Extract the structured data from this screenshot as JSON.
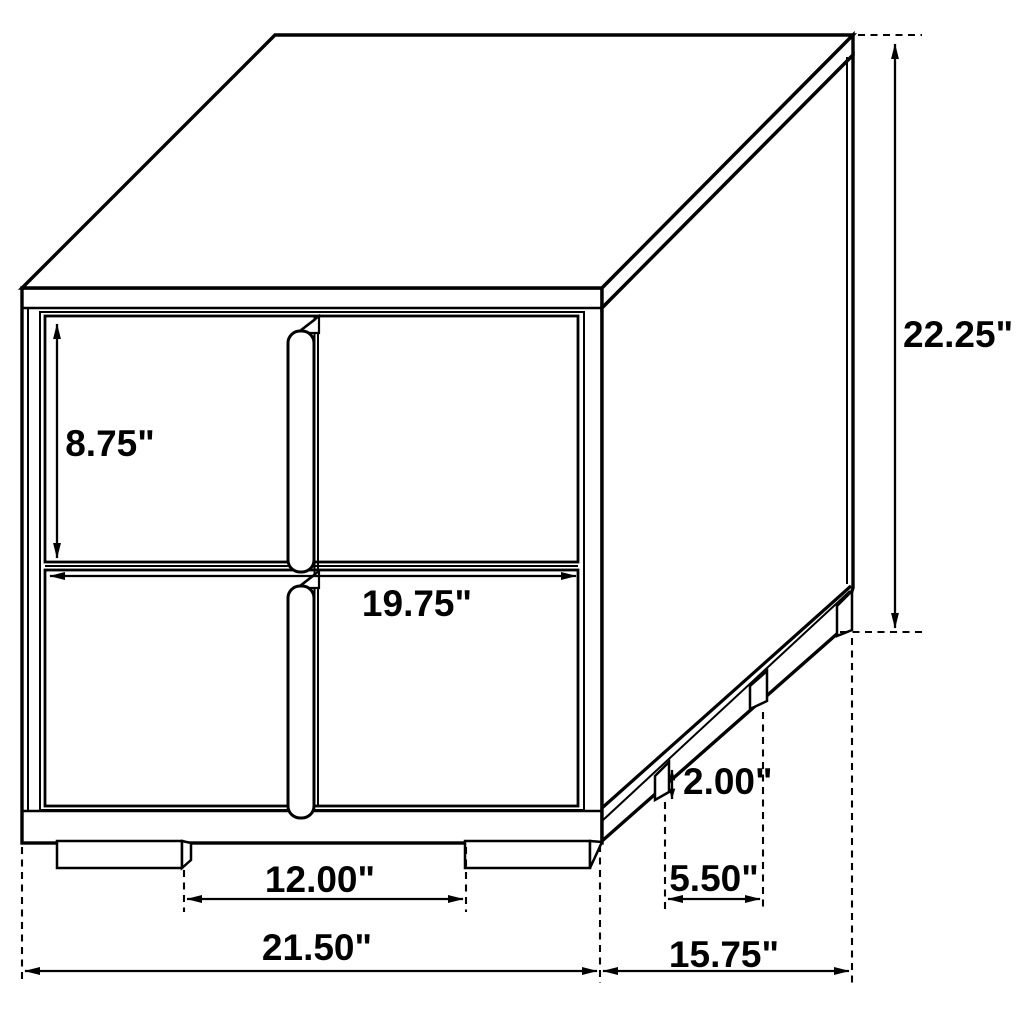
{
  "diagram": {
    "type": "furniture-dimension-drawing",
    "subject": "two-drawer nightstand line drawing",
    "units": "inches",
    "line_color": "#000000",
    "background_color": "#ffffff",
    "dimensions": {
      "drawer_front_height": "8.75\"",
      "drawer_front_width": "19.75\"",
      "overall_height": "22.25\"",
      "foot_height": "2.00\"",
      "front_feet_spacing": "12.00\"",
      "side_feet_spacing": "5.50\"",
      "overall_width": "21.50\"",
      "overall_depth": "15.75\""
    }
  }
}
